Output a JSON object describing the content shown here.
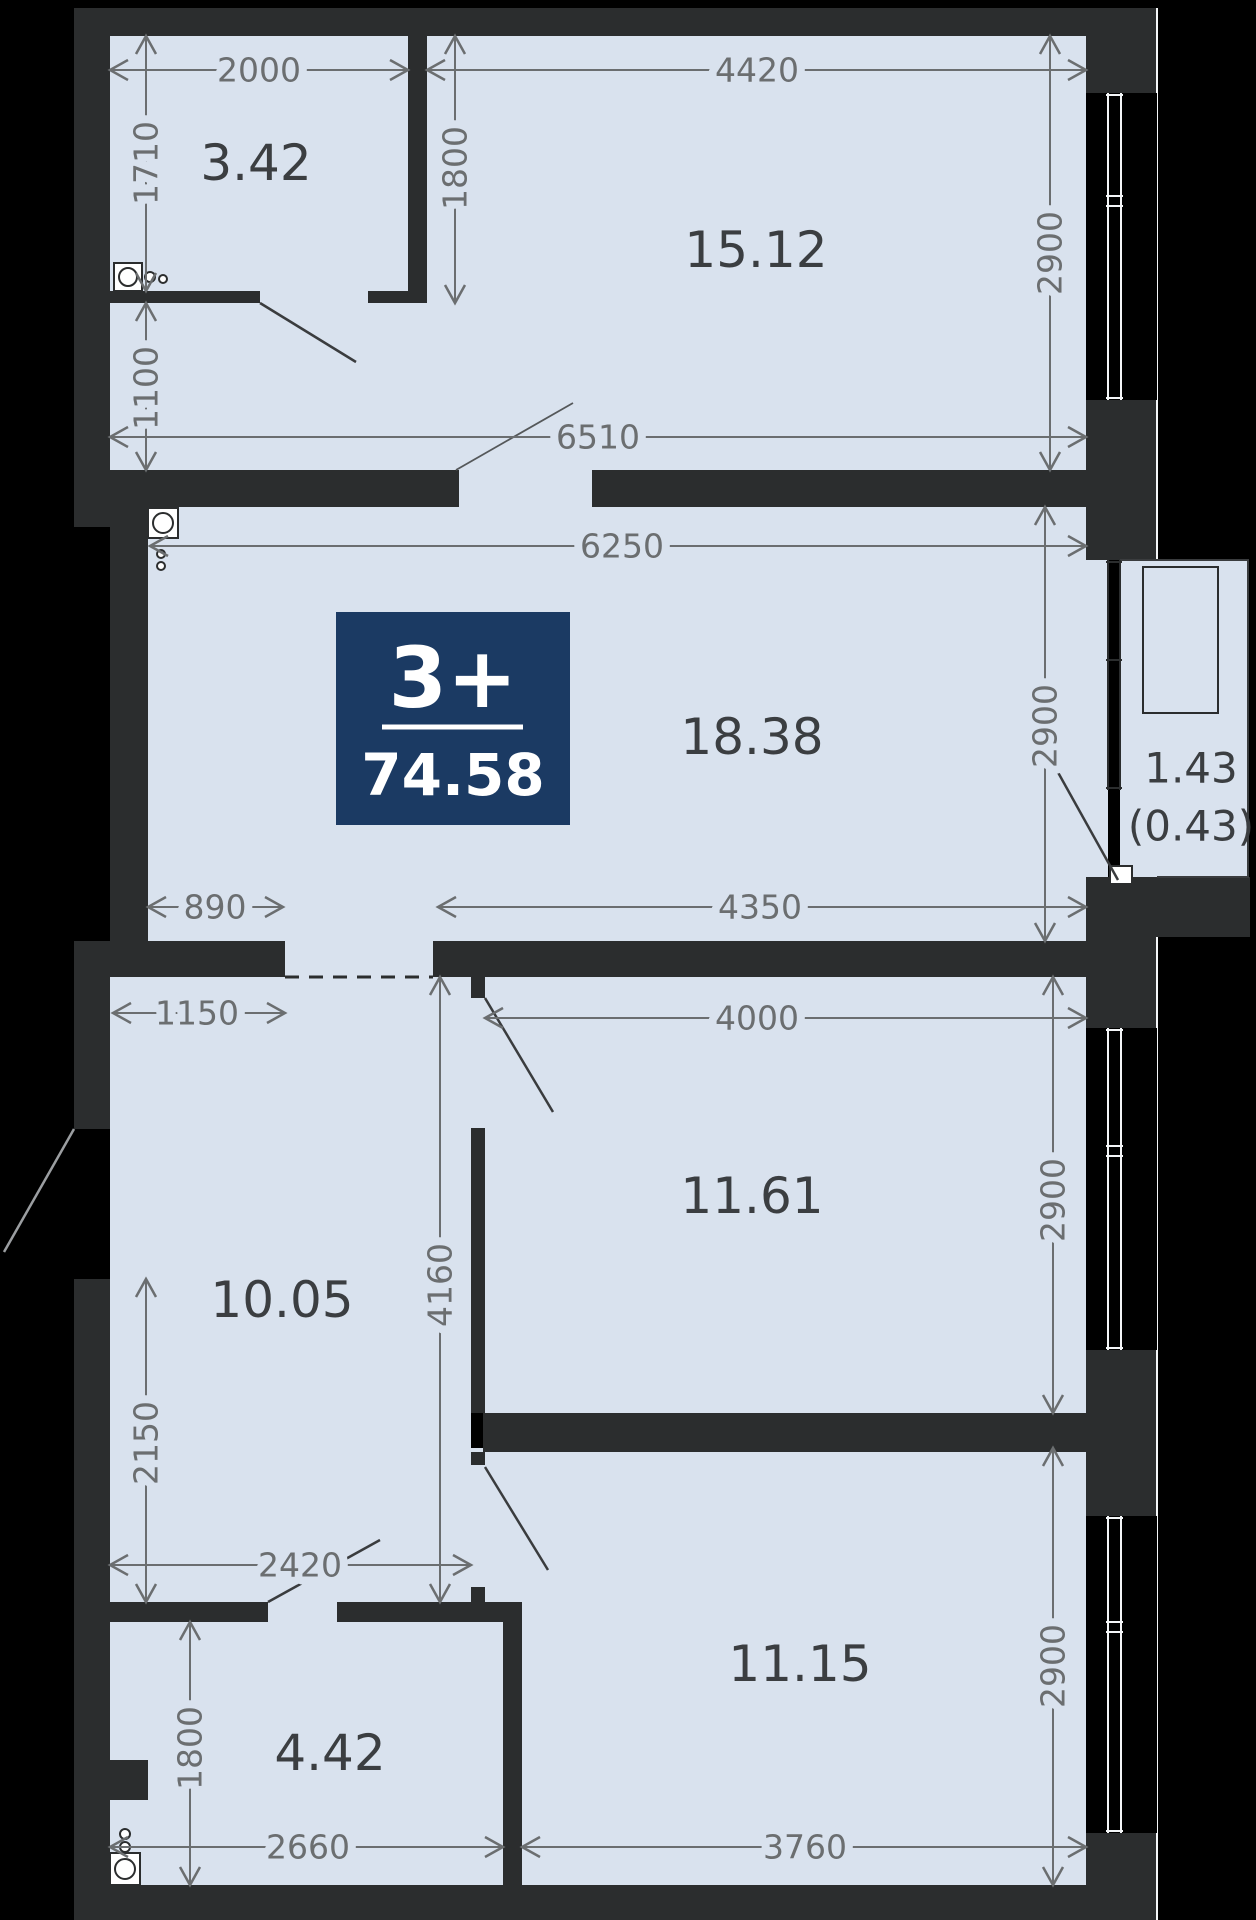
{
  "unit": {
    "type_label": "3+",
    "total_area": "74.58"
  },
  "rooms": {
    "bathroom": {
      "area": "3.42"
    },
    "kitchen": {
      "area": "15.12"
    },
    "living": {
      "area": "18.38"
    },
    "hall": {
      "area": "10.05"
    },
    "bedroom1": {
      "area": "11.61"
    },
    "bedroom2": {
      "area": "11.15"
    },
    "wc": {
      "area": "4.42"
    },
    "balcony": {
      "area_full": "1.43",
      "area_reduced": "(0.43)"
    }
  },
  "dims": {
    "w2000": "2000",
    "w4420": "4420",
    "h1710": "1710",
    "h1800_top": "1800",
    "h2900_kitchen": "2900",
    "h1100": "1100",
    "w6510": "6510",
    "w6250": "6250",
    "h2900_living": "2900",
    "w890": "890",
    "w4350": "4350",
    "w1150": "1150",
    "w4000": "4000",
    "h4160": "4160",
    "h2900_bedroom1": "2900",
    "h2150": "2150",
    "w2420": "2420",
    "h1800_wc": "1800",
    "w2660": "2660",
    "w3760": "3760",
    "h2900_bedroom2": "2900"
  },
  "colors": {
    "wall": "#2b2d2e",
    "floor": "#d9e2ee",
    "badge": "#1b3a63",
    "dim": "#6b6e70",
    "label": "#3b3e41",
    "background": "#000000"
  }
}
